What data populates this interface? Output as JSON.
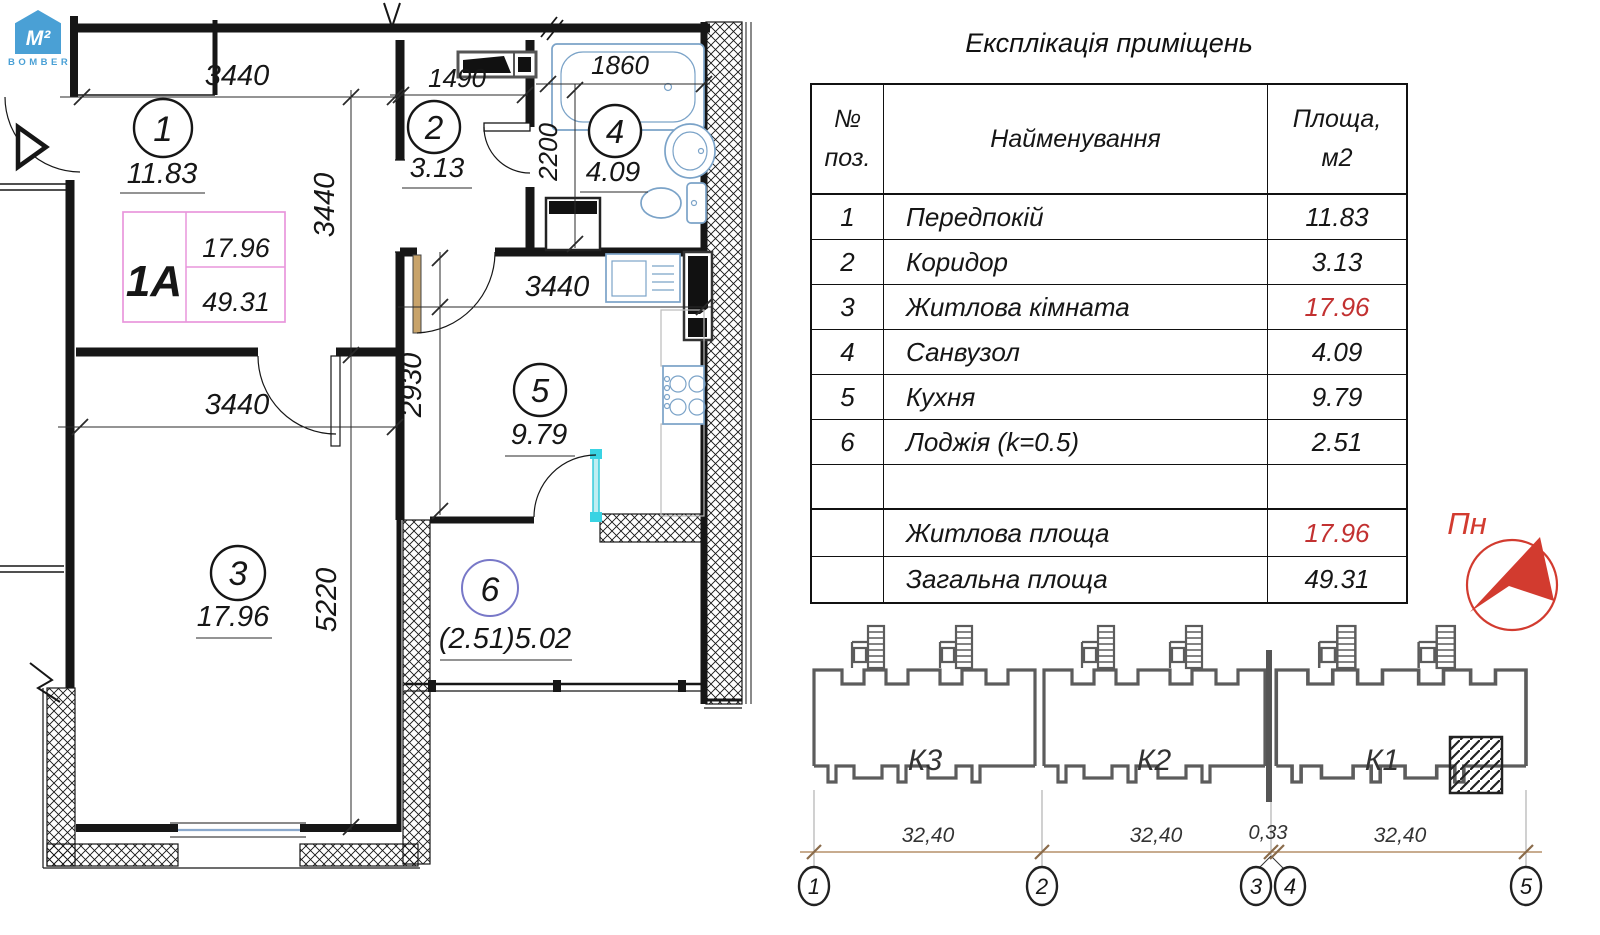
{
  "colors": {
    "accent_red": "#d23b2f",
    "fixture_blue": "#7ba3c8",
    "logo_blue": "#4aa0d5",
    "badge_pink": "#e896dc",
    "dim_tan": "#b5906a",
    "building_gray": "#5c5c5c",
    "cyan_door": "#39d3e3",
    "red_value": "#c23131"
  },
  "logo": {
    "mark": "M²",
    "brand": "BOMBER"
  },
  "explication": {
    "title": "Експлікація приміщень",
    "header": {
      "col1_line1": "№",
      "col1_line2": "поз.",
      "col2": "Найменування",
      "col3_line1": "Площа,",
      "col3_line2": "м2"
    },
    "rows": [
      {
        "num": "1",
        "name": "Передпокій",
        "area": "11.83"
      },
      {
        "num": "2",
        "name": "Коридор",
        "area": "3.13"
      },
      {
        "num": "3",
        "name": "Житлова кімната",
        "area": "17.96"
      },
      {
        "num": "4",
        "name": "Санвузол",
        "area": "4.09"
      },
      {
        "num": "5",
        "name": "Кухня",
        "area": "9.79"
      },
      {
        "num": "6",
        "name": "Лоджія (k=0.5)",
        "area": "2.51"
      },
      {
        "num": "",
        "name": "",
        "area": ""
      },
      {
        "num": "",
        "name": "Житлова площа",
        "area": "17.96"
      },
      {
        "num": "",
        "name": "Загальна площа",
        "area": "49.31"
      }
    ]
  },
  "plan": {
    "badge": {
      "type": "1A",
      "living_area": "17.96",
      "total_area": "49.31"
    },
    "rooms": [
      {
        "num": "1",
        "area": "11.83"
      },
      {
        "num": "2",
        "area": "3.13"
      },
      {
        "num": "3",
        "area": "17.96"
      },
      {
        "num": "4",
        "area": "4.09"
      },
      {
        "num": "5",
        "area": "9.79"
      },
      {
        "num": "6",
        "area": "(2.51)5.02"
      }
    ],
    "dims": {
      "hall_width": "3440",
      "hall_height": "3440",
      "corridor_width": "1490",
      "bath_width": "1860",
      "bath_height": "2200",
      "kitchen_width": "3440",
      "kitchen_height": "2930",
      "living_width": "3440",
      "living_height": "5220"
    }
  },
  "north": {
    "label": "Пн"
  },
  "section": {
    "blocks": [
      {
        "label": "К3"
      },
      {
        "label": "К2"
      },
      {
        "label": "К1"
      }
    ],
    "dims": [
      "32,40",
      "32,40",
      "0,33",
      "32,40"
    ],
    "axes": [
      "1",
      "2",
      "3",
      "4",
      "5"
    ]
  }
}
